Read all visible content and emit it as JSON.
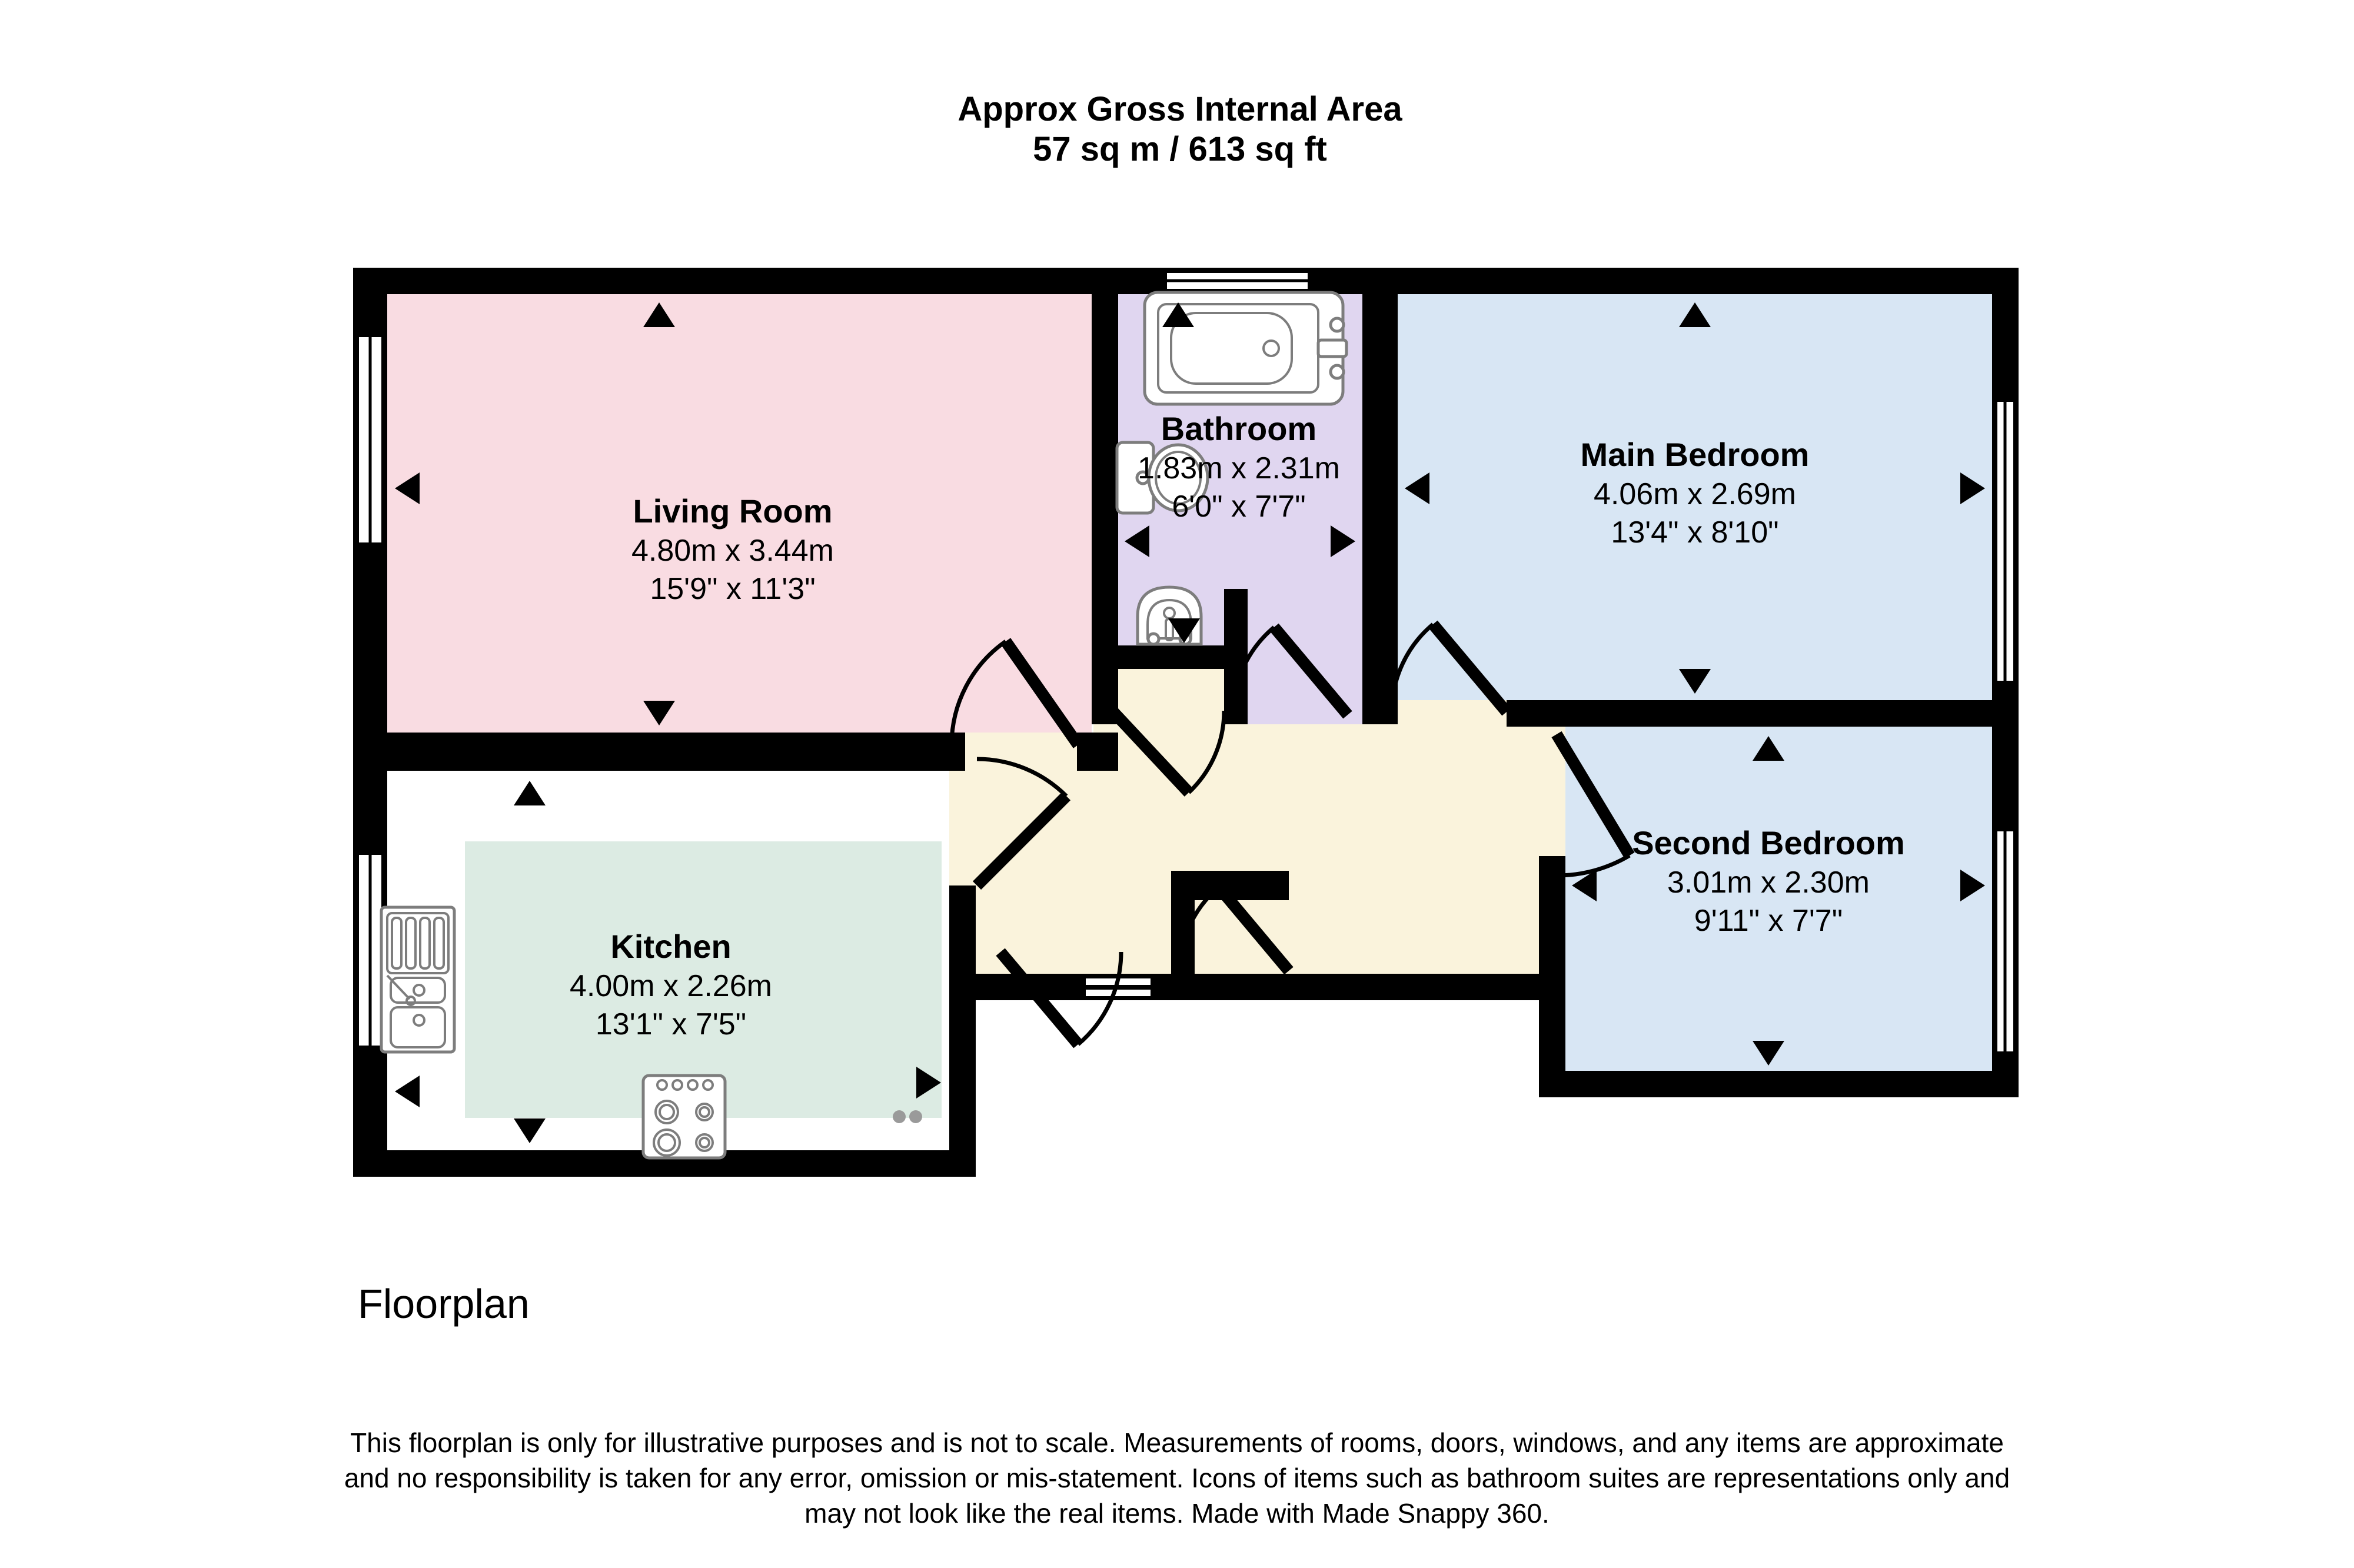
{
  "title": {
    "line1": "Approx Gross Internal Area",
    "line2": "57 sq m / 613 sq ft"
  },
  "rooms": {
    "living": {
      "name": "Living Room",
      "metric": "4.80m x 3.44m",
      "imperial": "15'9\" x 11'3\"",
      "color": "#f9dce2"
    },
    "kitchen": {
      "name": "Kitchen",
      "metric": "4.00m x 2.26m",
      "imperial": "13'1\" x 7'5\"",
      "color": "#dcebe3"
    },
    "bathroom": {
      "name": "Bathroom",
      "metric": "1.83m x 2.31m",
      "imperial": "6'0\" x 7'7\"",
      "color": "#e0d6f0"
    },
    "main_bedroom": {
      "name": "Main Bedroom",
      "metric": "4.06m x 2.69m",
      "imperial": "13'4\" x 8'10\"",
      "color": "#d8e6f4"
    },
    "second_bedroom": {
      "name": "Second Bedroom",
      "metric": "3.01m x 2.30m",
      "imperial": "9'11\" x 7'7\"",
      "color": "#d8e6f4"
    }
  },
  "hallway": {
    "color": "#faf3dc"
  },
  "wall_color": "#000000",
  "footer": {
    "label": "Floorplan",
    "disclaimer1": "This floorplan is only for illustrative purposes and is not to scale. Measurements of rooms, doors, windows, and any items are approximate",
    "disclaimer2": "and no responsibility is taken for any error, omission or mis-statement. Icons of items such as bathroom suites are representations only and",
    "disclaimer3": "may not look like the real items. Made with Made Snappy 360."
  }
}
